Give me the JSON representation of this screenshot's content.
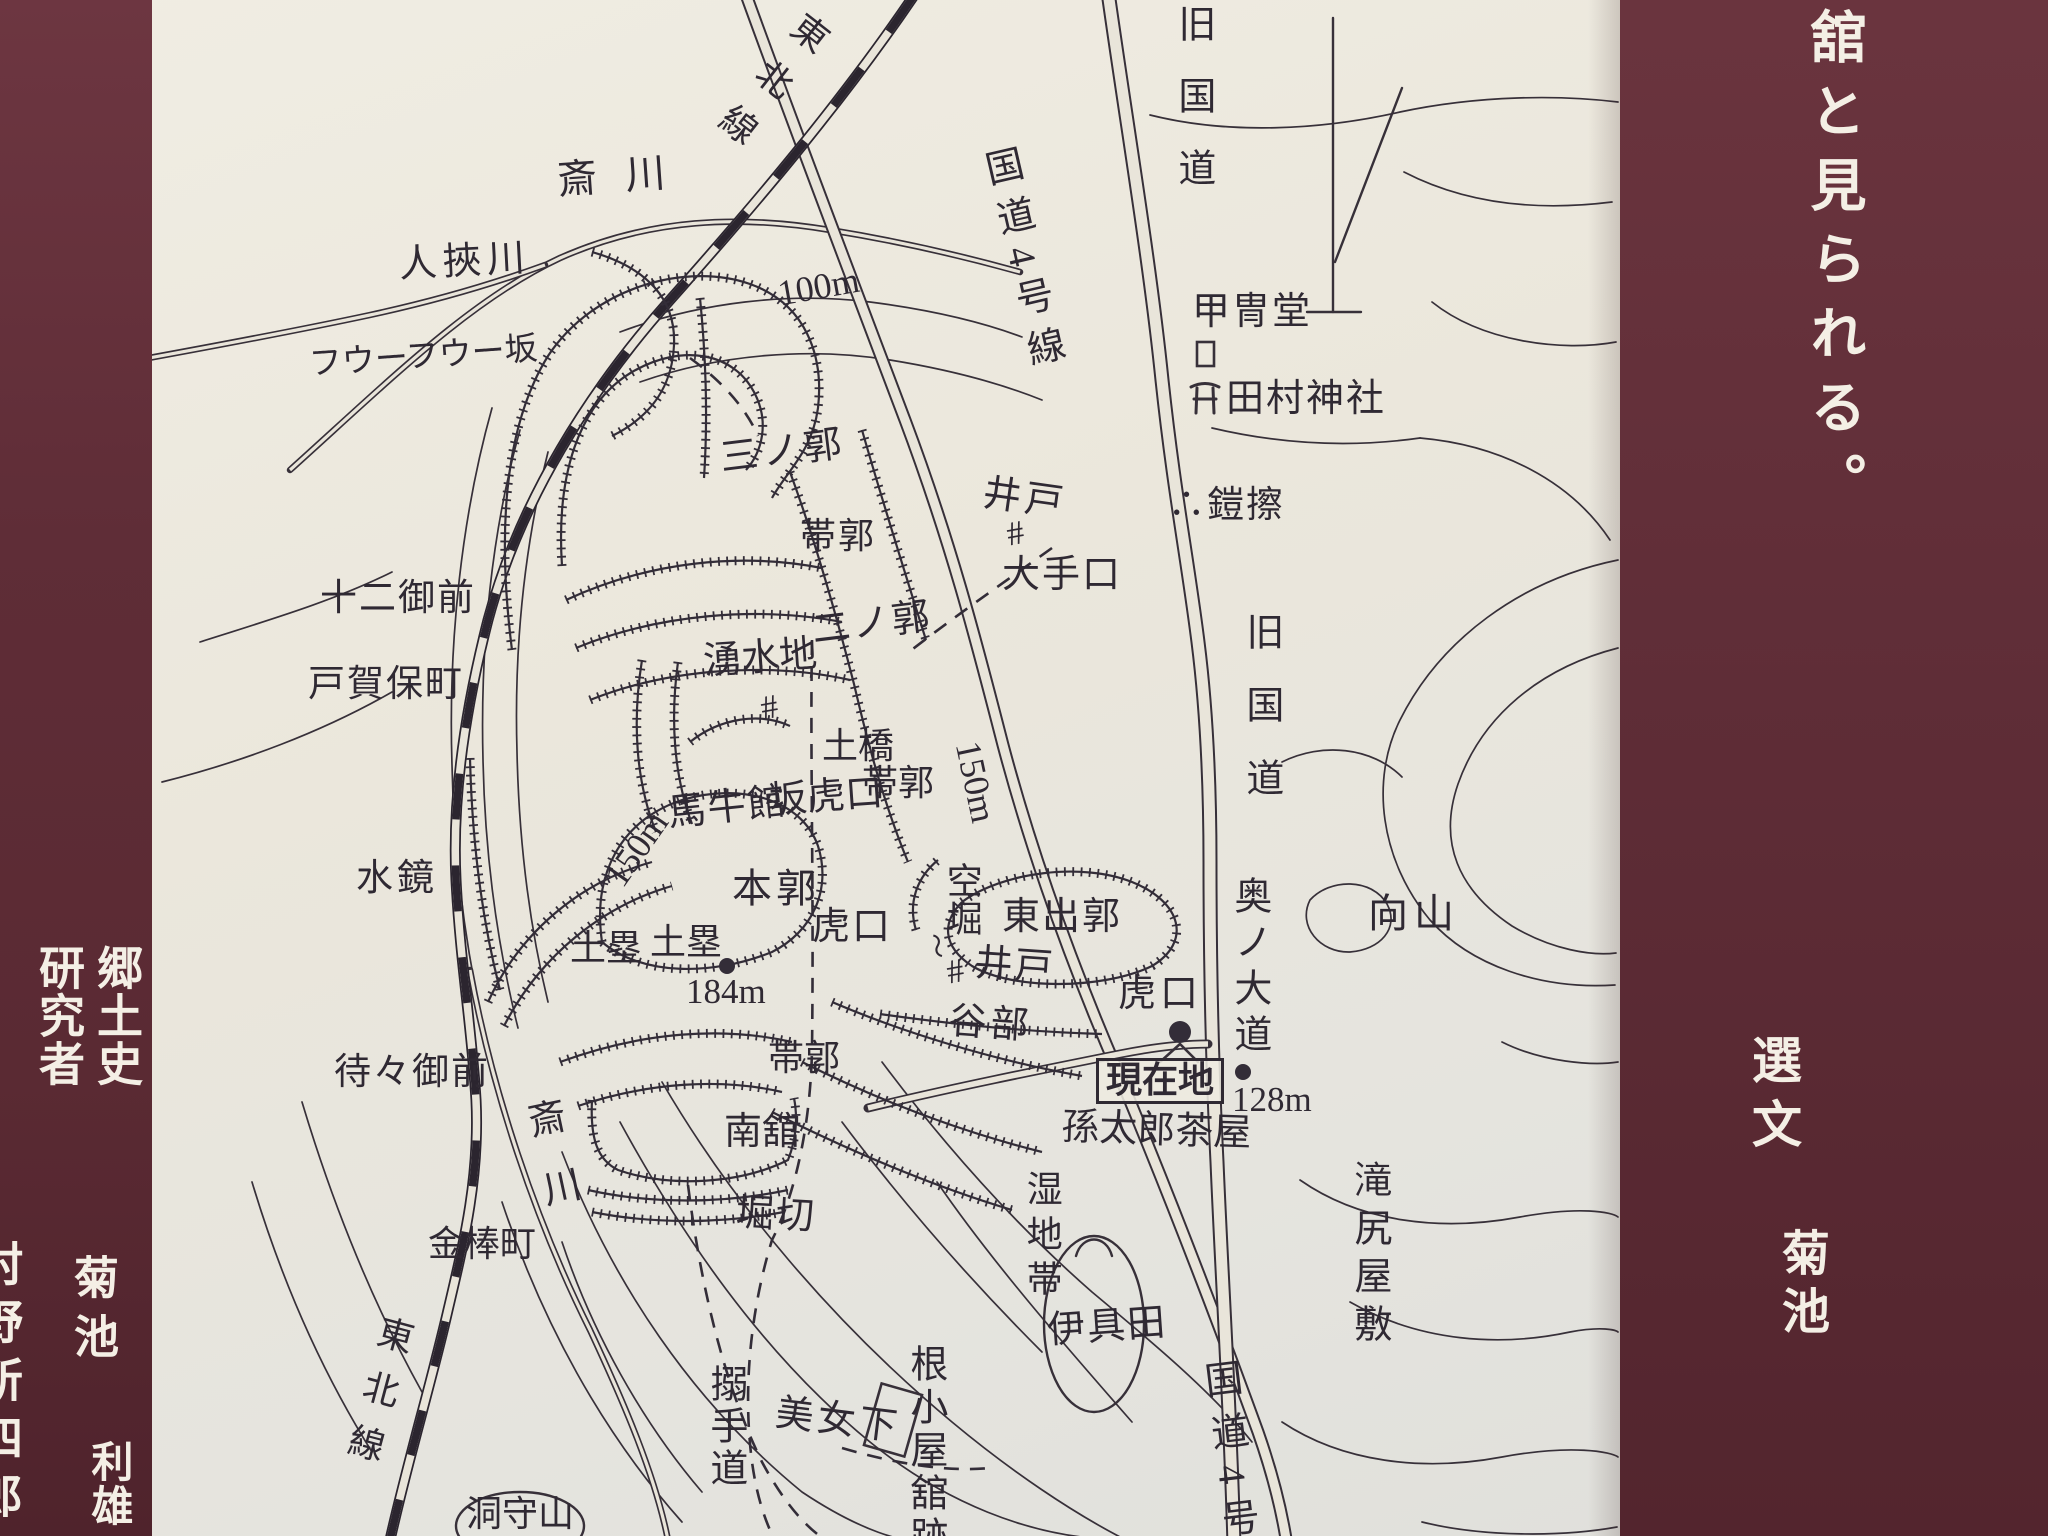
{
  "colors": {
    "panel_maroon": "#5f2d37",
    "paper": "#eae6db",
    "ink": "#332d38",
    "panel_text": "#f4efe5"
  },
  "sign": {
    "right_panel": {
      "headline": "舘と見られる。",
      "credit_role": "選文",
      "credit_name": "菊池"
    },
    "left_panel": {
      "line_main": "郷土史",
      "line_sub": "研究者",
      "name_family": "菊池",
      "name_given": "利雄",
      "edge_clipped_text": "村野所四郎"
    }
  },
  "map": {
    "labels": [
      {
        "n": "rail-label-top",
        "t": "東北線",
        "x": 800,
        "y": 16,
        "s": 36,
        "v": 1,
        "r": 38,
        "ls": 22
      },
      {
        "n": "sai-river-label-top",
        "t": "斎川",
        "x": 556,
        "y": 160,
        "s": 40,
        "ls": 28,
        "r": -4
      },
      {
        "n": "hitohasami-river-label",
        "t": "人挾川",
        "x": 398,
        "y": 246,
        "s": 38,
        "ls": 6,
        "r": -3
      },
      {
        "n": "fuufuu-slope-label",
        "t": "フウーフウー坂",
        "x": 308,
        "y": 348,
        "s": 33,
        "r": -4
      },
      {
        "n": "contour-100m-label",
        "t": "100m",
        "x": 775,
        "y": 276,
        "s": 36,
        "r": -10
      },
      {
        "n": "route4-label-top",
        "t": "国道4号線",
        "x": 975,
        "y": 148,
        "s": 38,
        "v": 1,
        "r": -13,
        "ls": 13
      },
      {
        "n": "old-national-road-label-top",
        "t": "旧国道",
        "x": 1172,
        "y": 4,
        "s": 38,
        "v": 1,
        "ls": 34
      },
      {
        "n": "kacchudo-label",
        "t": "甲冑堂",
        "x": 1192,
        "y": 293,
        "s": 38,
        "ls": 2
      },
      {
        "n": "tamura-shrine-label",
        "t": "田村神社",
        "x": 1226,
        "y": 380,
        "s": 38,
        "ls": 2
      },
      {
        "n": "yoroizure-label",
        "t": "∴鎧擦",
        "x": 1168,
        "y": 487,
        "s": 37,
        "ls": 2
      },
      {
        "n": "well-label-north",
        "t": "井戸",
        "x": 986,
        "y": 474,
        "s": 38,
        "ls": 4,
        "r": 8
      },
      {
        "n": "oteguchi-label",
        "t": "大手口",
        "x": 1002,
        "y": 556,
        "s": 38,
        "ls": 2
      },
      {
        "n": "third-bailey-label",
        "t": "三ノ郭",
        "x": 718,
        "y": 440,
        "s": 38,
        "ls": 4,
        "r": -7
      },
      {
        "n": "obi-kuruwa-label-north",
        "t": "帯郭",
        "x": 800,
        "y": 518,
        "s": 36,
        "ls": 2
      },
      {
        "n": "second-bailey-label",
        "t": "二ノ郭",
        "x": 810,
        "y": 612,
        "s": 38,
        "ls": 2,
        "r": -7
      },
      {
        "n": "spring-label",
        "t": "湧水地",
        "x": 702,
        "y": 643,
        "s": 38,
        "r": -4
      },
      {
        "n": "dobashi-label",
        "t": "土橋",
        "x": 822,
        "y": 728,
        "s": 36
      },
      {
        "n": "obi-kuruwa-label-mid",
        "t": "帯郭",
        "x": 862,
        "y": 765,
        "s": 36
      },
      {
        "n": "saka-koguchi-label",
        "t": "坂虎口",
        "x": 768,
        "y": 782,
        "s": 38,
        "r": -4
      },
      {
        "n": "bagyukan-label",
        "t": "馬牛館",
        "x": 666,
        "y": 795,
        "s": 38,
        "ls": 2,
        "r": -6
      },
      {
        "n": "contour-150m-label-west",
        "t": "150m",
        "x": 598,
        "y": 872,
        "s": 36,
        "r": -55
      },
      {
        "n": "contour-150m-label-east",
        "t": "150m",
        "x": 985,
        "y": 738,
        "s": 36,
        "r": 78
      },
      {
        "n": "main-bailey-label",
        "t": "本郭",
        "x": 732,
        "y": 868,
        "s": 40,
        "ls": 4
      },
      {
        "n": "dorui-label-west",
        "t": "土塁",
        "x": 570,
        "y": 930,
        "s": 36
      },
      {
        "n": "dorui-label-east",
        "t": "土塁",
        "x": 650,
        "y": 924,
        "s": 36
      },
      {
        "n": "elevation-184m-label",
        "t": "184m",
        "x": 686,
        "y": 974,
        "s": 35
      },
      {
        "n": "koguchi-label-center",
        "t": "虎口",
        "x": 812,
        "y": 908,
        "s": 38,
        "ls": 2
      },
      {
        "n": "karabori-label",
        "t": "空堀",
        "x": 942,
        "y": 862,
        "s": 36,
        "v": 1,
        "ls": 2
      },
      {
        "n": "squiggle-mark",
        "t": "〜",
        "x": 946,
        "y": 930,
        "s": 26,
        "r": 75
      },
      {
        "n": "east-bailey-label",
        "t": "東出郭",
        "x": 1002,
        "y": 898,
        "s": 38,
        "ls": 2
      },
      {
        "n": "well-label-east",
        "t": "井戸",
        "x": 976,
        "y": 944,
        "s": 38,
        "ls": 2,
        "r": 4
      },
      {
        "n": "tanibu-label",
        "t": "谷部",
        "x": 950,
        "y": 1002,
        "s": 38,
        "ls": 4,
        "r": 4
      },
      {
        "n": "koguchi-label-east",
        "t": "虎口",
        "x": 1118,
        "y": 975,
        "s": 38,
        "ls": 4
      },
      {
        "n": "genzaichi-label",
        "t": "現在地",
        "x": 1096,
        "y": 1058,
        "s": 36,
        "box": 1
      },
      {
        "n": "magotaro-chaya-label",
        "t": "孫太郎茶屋",
        "x": 1062,
        "y": 1108,
        "s": 38,
        "r": 2
      },
      {
        "n": "elevation-128m-label",
        "t": "128m",
        "x": 1232,
        "y": 1082,
        "s": 35
      },
      {
        "n": "oku-no-daido-label",
        "t": "奥ノ大道",
        "x": 1228,
        "y": 876,
        "s": 38,
        "v": 1,
        "ls": 8
      },
      {
        "n": "old-national-road-label-mid",
        "t": "旧国道",
        "x": 1240,
        "y": 612,
        "s": 38,
        "v": 1,
        "ls": 35
      },
      {
        "n": "mukaiyama-label",
        "t": "向山",
        "x": 1368,
        "y": 893,
        "s": 40,
        "ls": 6
      },
      {
        "n": "obi-kuruwa-label-south",
        "t": "帯郭",
        "x": 768,
        "y": 1040,
        "s": 36
      },
      {
        "n": "minamidate-label",
        "t": "南舘",
        "x": 724,
        "y": 1113,
        "s": 38
      },
      {
        "n": "horikiri-label",
        "t": "堀切",
        "x": 737,
        "y": 1194,
        "s": 38,
        "ls": 2,
        "r": 3
      },
      {
        "n": "wetland-label",
        "t": "湿地帯",
        "x": 1022,
        "y": 1170,
        "s": 36,
        "v": 1,
        "ls": 9
      },
      {
        "n": "takijiri-yashiki-label",
        "t": "滝尻屋敷",
        "x": 1348,
        "y": 1160,
        "s": 38,
        "v": 1,
        "ls": 10
      },
      {
        "n": "iguta-label",
        "t": "伊具田",
        "x": 1046,
        "y": 1312,
        "s": 38,
        "ls": 2,
        "r": -4
      },
      {
        "n": "sai-river-label-mid",
        "t": "斎川",
        "x": 518,
        "y": 1100,
        "s": 38,
        "v": 1,
        "r": -12,
        "ls": 32
      },
      {
        "n": "kanabocho-label",
        "t": "金棒町",
        "x": 428,
        "y": 1226,
        "s": 36
      },
      {
        "n": "rail-label-bottom",
        "t": "東北線",
        "x": 378,
        "y": 1316,
        "s": 36,
        "v": 1,
        "r": 15,
        "ls": 20
      },
      {
        "n": "karametedo-label",
        "t": "搦手道",
        "x": 704,
        "y": 1364,
        "s": 38,
        "v": 1,
        "ls": 4
      },
      {
        "n": "bijoshita-label",
        "t": "美女下",
        "x": 778,
        "y": 1394,
        "s": 38,
        "ls": 4,
        "r": 7
      },
      {
        "n": "negoya-date-label",
        "t": "根小屋舘跡",
        "x": 904,
        "y": 1344,
        "s": 38,
        "v": 1,
        "ls": 5
      },
      {
        "n": "horamoriyama-label",
        "t": "洞守山",
        "x": 466,
        "y": 1496,
        "s": 36
      },
      {
        "n": "route4-label-bottom",
        "t": "国道4号",
        "x": 1196,
        "y": 1360,
        "s": 38,
        "v": 1,
        "r": -7,
        "ls": 15
      },
      {
        "n": "twelve-gozen-label",
        "t": "十二御前",
        "x": 320,
        "y": 580,
        "s": 37,
        "ls": 2
      },
      {
        "n": "togabo-cho-label",
        "t": "戸賀保町",
        "x": 308,
        "y": 666,
        "s": 37,
        "ls": 2
      },
      {
        "n": "mizukagami-label",
        "t": "水鏡",
        "x": 356,
        "y": 860,
        "s": 37,
        "ls": 4
      },
      {
        "n": "machimachi-gozen-label",
        "t": "待々御前",
        "x": 334,
        "y": 1054,
        "s": 37,
        "ls": 2
      },
      {
        "n": "well-symbol-spring",
        "t": "#",
        "x": 758,
        "y": 692,
        "s": 34,
        "r": -10
      },
      {
        "n": "well-symbol-north",
        "t": "#",
        "x": 1004,
        "y": 518,
        "s": 34,
        "r": -10
      },
      {
        "n": "well-symbol-east",
        "t": "#",
        "x": 944,
        "y": 956,
        "s": 34,
        "r": -10
      }
    ]
  }
}
